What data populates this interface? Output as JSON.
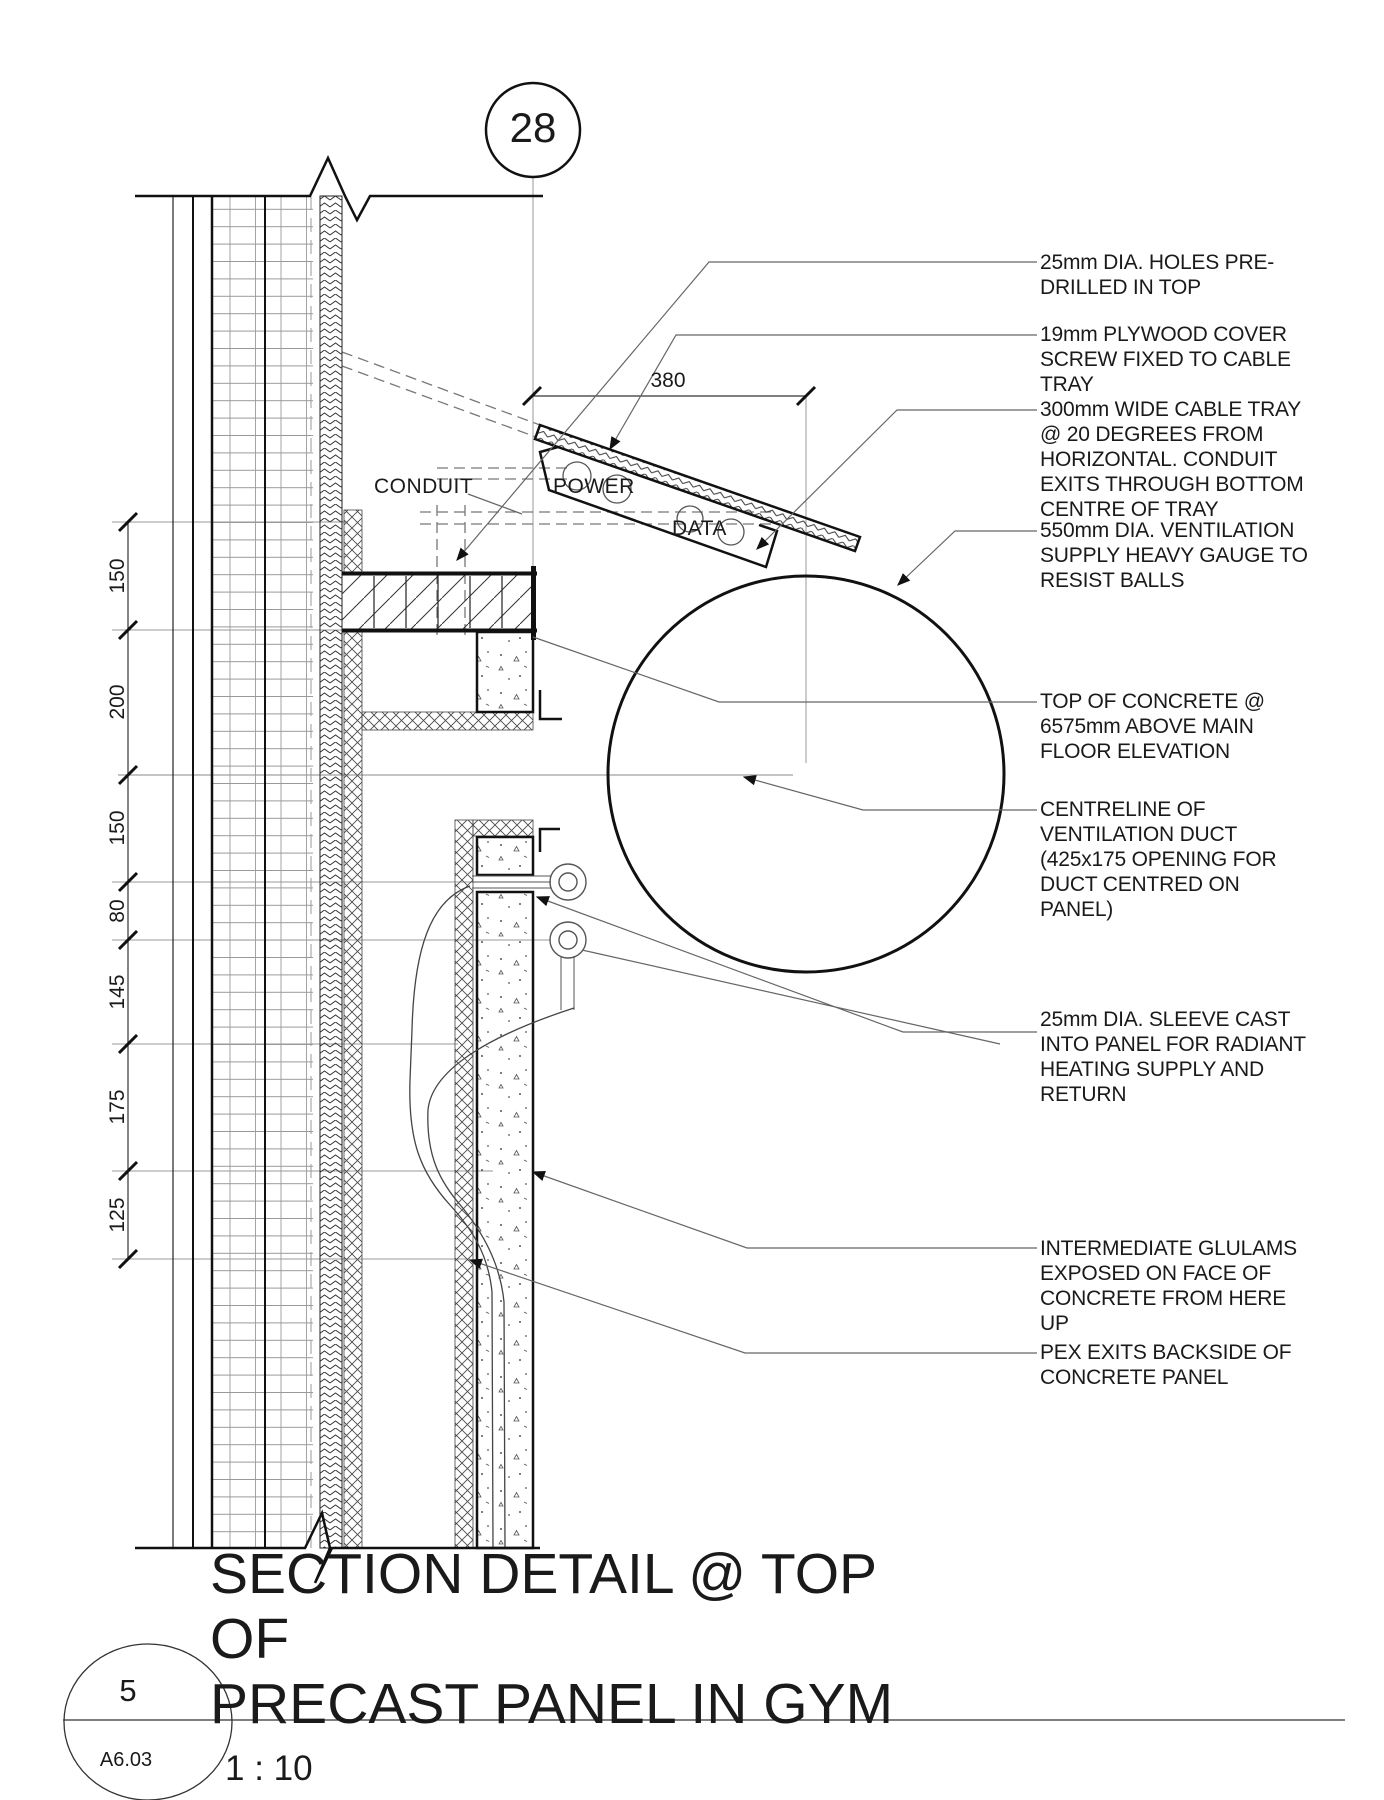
{
  "colors": {
    "ink": "#1a1a1a",
    "background": "#ffffff",
    "leader_gray": "#666666"
  },
  "drawing": {
    "detail_number": "28",
    "title": "SECTION DETAIL @ TOP OF\nPRECAST PANEL IN GYM",
    "scale": "1 : 10",
    "bubble": {
      "number": "5",
      "sheet": "A6.03"
    }
  },
  "tray_labels": {
    "conduit": "CONDUIT",
    "power": "POWER",
    "data": "DATA"
  },
  "dimensions": {
    "horizontal_width": "380",
    "vertical_chain": [
      "150",
      "200",
      "150",
      "80",
      "145",
      "175",
      "125"
    ]
  },
  "annotations": [
    {
      "id": "holes",
      "text": "25mm DIA. HOLES PRE-\nDRILLED IN TOP"
    },
    {
      "id": "plywood",
      "text": "19mm PLYWOOD COVER\nSCREW FIXED TO CABLE\nTRAY"
    },
    {
      "id": "cabletray",
      "text": "300mm WIDE CABLE TRAY\n@ 20 DEGREES FROM\nHORIZONTAL. CONDUIT\nEXITS THROUGH BOTTOM\nCENTRE OF TRAY"
    },
    {
      "id": "vent",
      "text": "550mm DIA. VENTILATION\nSUPPLY HEAVY GAUGE TO\nRESIST BALLS"
    },
    {
      "id": "topconc",
      "text": "TOP OF CONCRETE @\n6575mm ABOVE MAIN\nFLOOR ELEVATION"
    },
    {
      "id": "centreline",
      "text": "CENTRELINE OF\nVENTILATION DUCT\n(425x175 OPENING FOR\nDUCT CENTRED ON PANEL)"
    },
    {
      "id": "sleeve",
      "text": "25mm DIA. SLEEVE CAST\nINTO PANEL FOR RADIANT\nHEATING SUPPLY AND\nRETURN"
    },
    {
      "id": "glulams",
      "text": "INTERMEDIATE GLULAMS\nEXPOSED ON FACE OF\nCONCRETE FROM HERE UP"
    },
    {
      "id": "pex",
      "text": "PEX EXITS BACKSIDE OF\nCONCRETE PANEL"
    }
  ]
}
